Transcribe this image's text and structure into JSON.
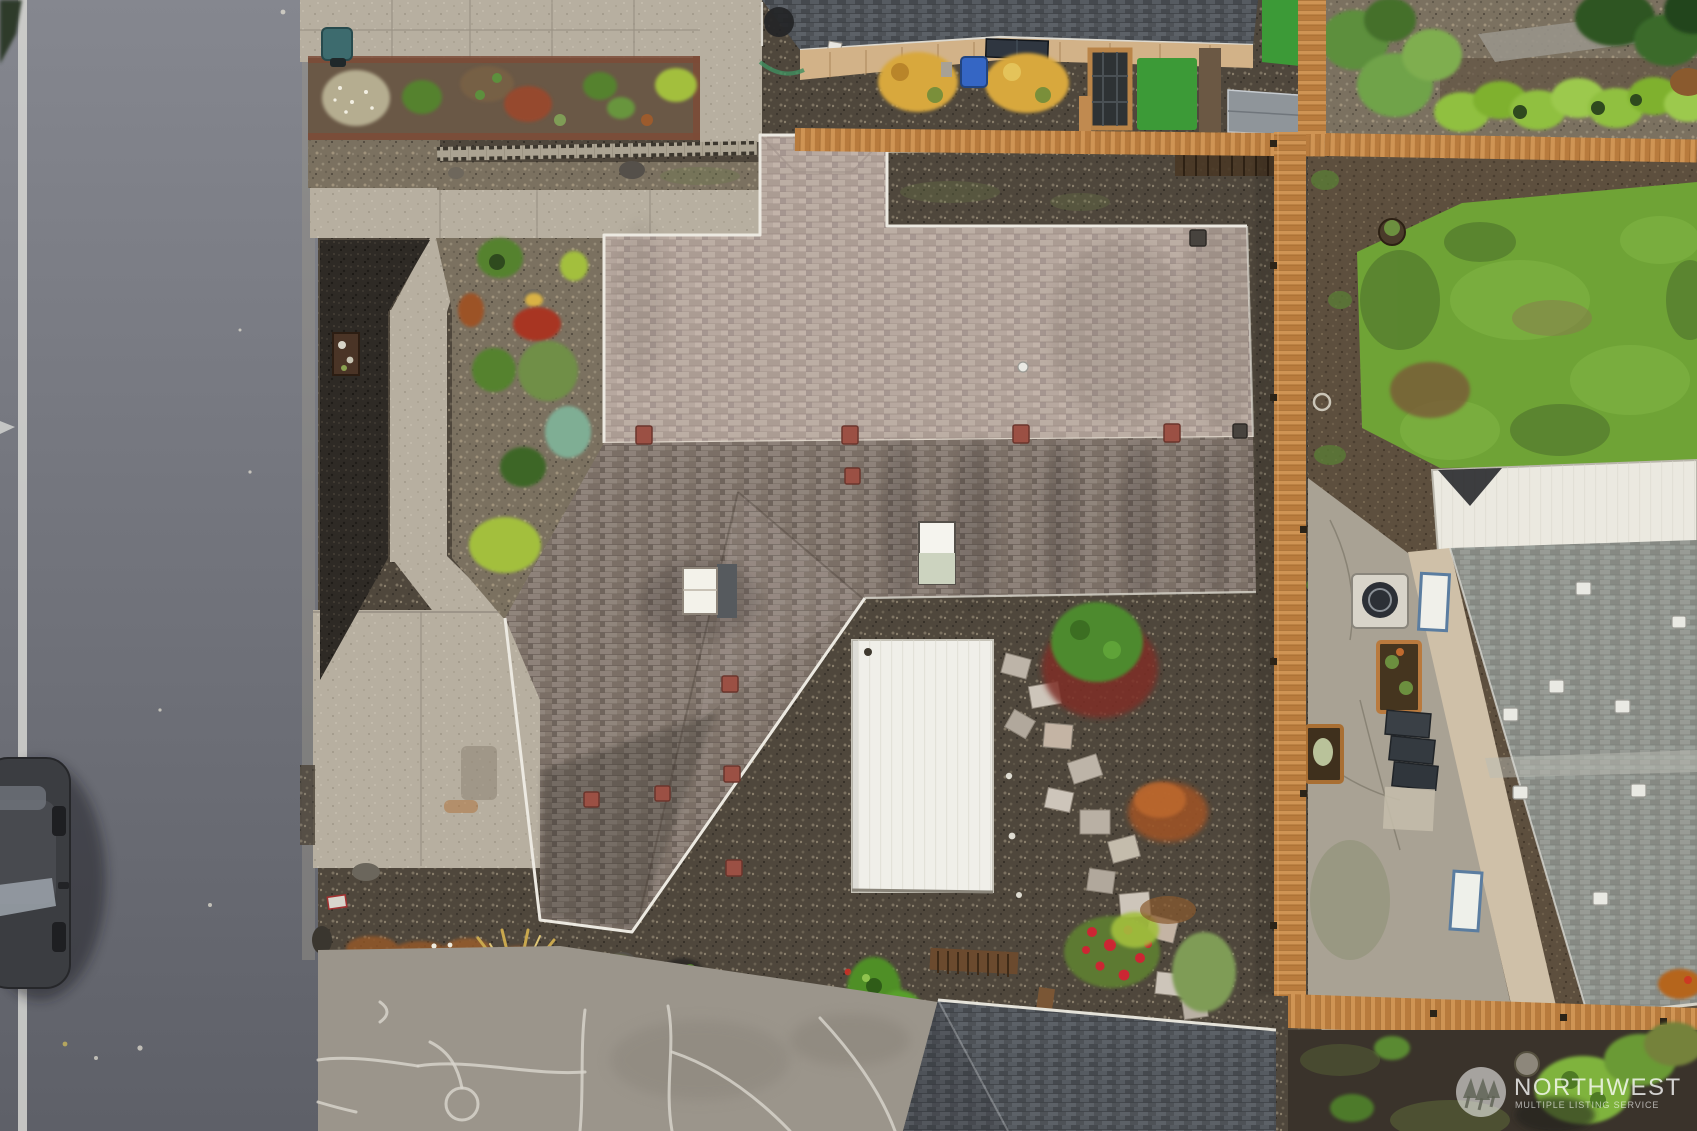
{
  "meta": {
    "kind": "aerial-drone-photograph",
    "view": "top-down overhead view of a residential property on an autumn day"
  },
  "watermark": {
    "brand": "NORTHWEST",
    "tagline": "MULTIPLE LISTING SERVICE",
    "logo": "three-pine-trees-in-circle-icon"
  },
  "palette": {
    "roadTop": "#85878f",
    "roadBottom": "#5e6068",
    "roadLine": "#d6d6d2",
    "concrete": "#b7afa0",
    "concreteLight": "#c7bfae",
    "mulch": "#2e2a25",
    "gravelFront": "#7b7160",
    "gravelBack": "#4f473c",
    "soil": "#6a5846",
    "dirt": "#5d4f3e",
    "roofLightSlope": "#b3a49b",
    "roofDarkSlope": "#85796f",
    "roofNeighborTop": "#4e5257",
    "roofNeighborRight": "#8f928c",
    "roofGarage": "#4b5057",
    "patioWhite": "#f0efe9",
    "metalWhite": "#ebe9e0",
    "fenceWood": "#c5894a",
    "lawn": "#6fa336",
    "turf": "#3c9a37",
    "hedge": "#90c040",
    "siding": "#cfc0a8",
    "windowBlue": "#5b7da0",
    "carBody": "#3b3d41",
    "watermarkText": "rgba(255,255,255,0.78)"
  },
  "scene": {
    "regions": [
      {
        "name": "street",
        "desc": "asphalt road with painted white edge line, left side"
      },
      {
        "name": "parked-car",
        "desc": "dark gray car parked along left curb, partially cropped"
      },
      {
        "name": "front-sidewalk",
        "desc": "concrete sidewalk and entry walk"
      },
      {
        "name": "front-garden-beds",
        "desc": "soil and gravel beds with green, red and lime shrubs"
      },
      {
        "name": "mulch-bed",
        "desc": "dark bark mulch area between street and walkway"
      },
      {
        "name": "cinder-block-border",
        "desc": "row of cinder blocks edging the front beds"
      },
      {
        "name": "subject-house-roof",
        "desc": "large composition-shingle roof, light north slope and dark south slope with gable wing"
      },
      {
        "name": "skylights",
        "desc": "two white skylights on the roof"
      },
      {
        "name": "roof-vents",
        "desc": "scattered reddish roof vents"
      },
      {
        "name": "covered-patio",
        "desc": "white flat patio cover at rear of house"
      },
      {
        "name": "flagstone-path",
        "desc": "flagstone walkway through gravel backyard"
      },
      {
        "name": "backyard-gravel",
        "desc": "dark pea-gravel rear yard with shrubs and rose bed"
      },
      {
        "name": "wood-privacy-fence",
        "desc": "orange-tan cedar fence along top, right and bottom-right"
      },
      {
        "name": "neighbor-top",
        "desc": "neighboring house roof, deck, yellow shrubs, pergola, artificial turf and shed"
      },
      {
        "name": "neighbor-right",
        "desc": "neighbor backyard lawn, hedge row, gray-roof house with white metal carport roof"
      },
      {
        "name": "heat-pump",
        "desc": "AC/heat-pump unit beside right neighbor house"
      },
      {
        "name": "garage-roof-bottom",
        "desc": "dark gray garage/shed roof at bottom center"
      },
      {
        "name": "shared-driveway",
        "desc": "aged concrete drive with white crack-seal lines, bottom"
      },
      {
        "name": "ornamental-grass",
        "desc": "straw-colored fountain grass in bottom gravel bed"
      },
      {
        "name": "mls-watermark",
        "desc": "semi-transparent Northwest MLS logo and text, bottom right"
      }
    ]
  }
}
